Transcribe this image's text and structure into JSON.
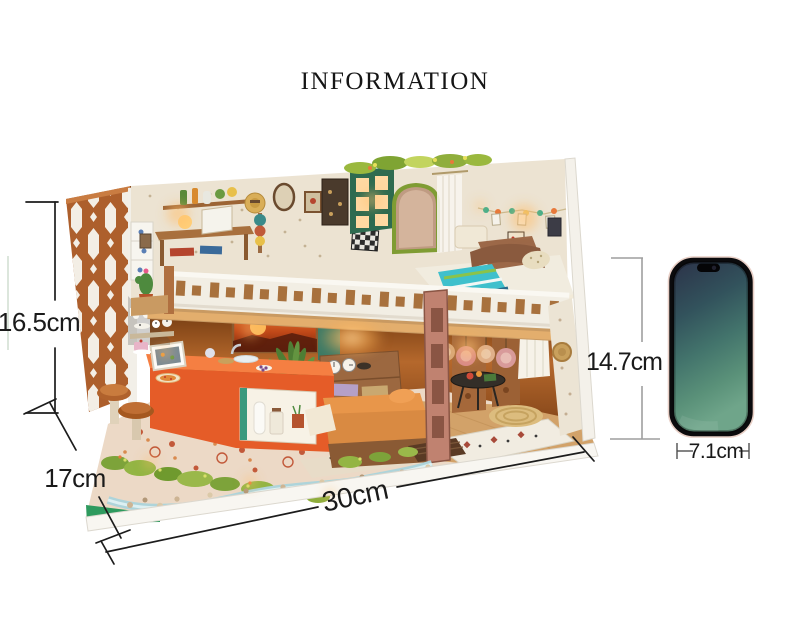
{
  "page": {
    "title": "INFORMATION",
    "background": "#ffffff"
  },
  "annotations": {
    "house_height": "16.5cm",
    "house_depth": "17cm",
    "house_width": "30cm",
    "phone_height": "14.7cm",
    "phone_width": "7.1cm"
  },
  "figure": {
    "alt": "Miniature two-story DIY dollhouse interior with loft bedroom, kitchen, lights and garden",
    "comparison_object": "smartphone"
  },
  "colors": {
    "dimension_line": "#1c1c1c",
    "phone_line_gray": "#9e9e9e",
    "lattice_wood": "#ad5f2c",
    "kitchen_orange": "#e55c28",
    "railing_white": "#f2eee4",
    "grass_green": "#2da052",
    "phone_screen_top": "#2c3349",
    "phone_screen_bottom": "#6fa58a"
  }
}
